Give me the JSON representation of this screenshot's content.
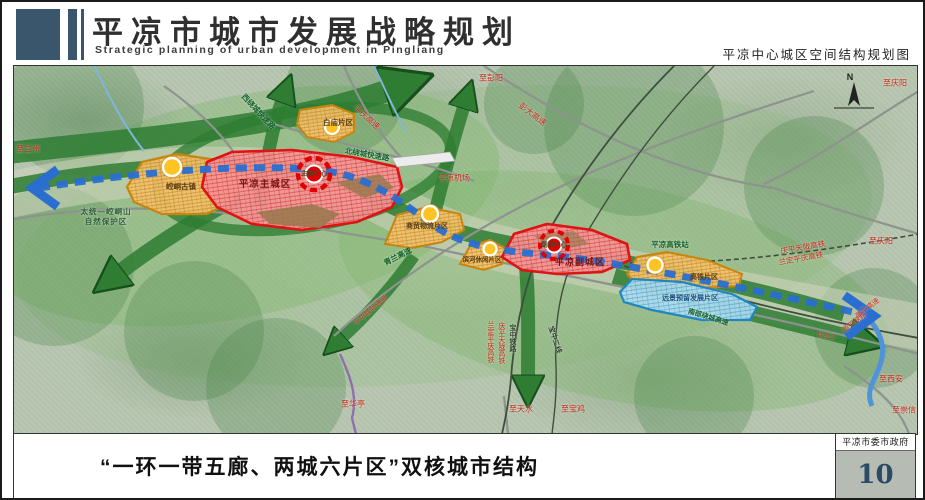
{
  "header": {
    "title_cn": "平凉市城市发展战略规划",
    "title_en": "Strategic planning of urban development in Pingliang",
    "map_subtitle": "平凉中心城区空间结构规划图"
  },
  "footer": {
    "caption": "“一环一带五廊、两城六片区”双核城市结构",
    "gov_label": "平凉市委市政府",
    "page_number": "10"
  },
  "map": {
    "compass_label": "N",
    "colors": {
      "corridor_green": "#2e7d32",
      "axis_blue": "#2a6fd0",
      "city_red": "#e01212",
      "zone_orange": "#e8a12c",
      "reserve_blue": "#1f86c0",
      "terrain": "#b7c6b0"
    },
    "labels": [
      {
        "id": "to-lanzhou",
        "text": "至兰州",
        "kind": "red"
      },
      {
        "id": "west-ring-road",
        "text": "西绕城快速路",
        "kind": "green"
      },
      {
        "id": "north-ring-road",
        "text": "北绕城快速路",
        "kind": "green"
      },
      {
        "id": "pingqing-expressway",
        "text": "平庆高速",
        "kind": "red"
      },
      {
        "id": "to-pengyang",
        "text": "至彭阳",
        "kind": "red"
      },
      {
        "id": "pengda-expressway",
        "text": "彭大高速",
        "kind": "red"
      },
      {
        "id": "to-qingyang-top",
        "text": "至庆阳",
        "kind": "red"
      },
      {
        "id": "pingliang-airport",
        "text": "平凉机场",
        "kind": "red"
      },
      {
        "id": "qinglan-expressway",
        "text": "青兰高速",
        "kind": "green"
      },
      {
        "id": "nature-reserve-line1",
        "text": "太统—崆峒山",
        "kind": "nature"
      },
      {
        "id": "nature-reserve-line2",
        "text": "自然保护区",
        "kind": "nature"
      },
      {
        "id": "main-city",
        "text": "平凉主城区",
        "kind": "city"
      },
      {
        "id": "main-center",
        "text": "主城中心",
        "kind": "center"
      },
      {
        "id": "kongtong-town",
        "text": "崆峒古镇",
        "kind": "zone"
      },
      {
        "id": "baimiao-district",
        "text": "白庙片区",
        "kind": "zone"
      },
      {
        "id": "logistics-district",
        "text": "商贸物流片区",
        "kind": "zone"
      },
      {
        "id": "riverside-district",
        "text": "滨河休闲片区",
        "kind": "zone"
      },
      {
        "id": "sub-city",
        "text": "平凉副城区",
        "kind": "city"
      },
      {
        "id": "sub-center",
        "text": "副城中心",
        "kind": "center"
      },
      {
        "id": "hsr-station",
        "text": "平凉高铁站",
        "kind": "green"
      },
      {
        "id": "hsr-district",
        "text": "高铁片区",
        "kind": "zone"
      },
      {
        "id": "reserve-district",
        "text": "远景预留发展片区",
        "kind": "reserve"
      },
      {
        "id": "south-ring-expressway",
        "text": "南部绕城高速",
        "kind": "green"
      },
      {
        "id": "qingpingtianlong-hsr",
        "text": "庆平天陇高铁",
        "kind": "red"
      },
      {
        "id": "landingpingqing-hsr",
        "text": "兰定平庆高铁",
        "kind": "red"
      },
      {
        "id": "to-qingyang-east",
        "text": "至庆阳",
        "kind": "red"
      },
      {
        "id": "g312",
        "text": "G312",
        "kind": "red"
      },
      {
        "id": "xiping-expressway",
        "text": "西平高速",
        "kind": "red"
      },
      {
        "id": "xiping-railway",
        "text": "西平铁路",
        "kind": "red"
      },
      {
        "id": "to-xian",
        "text": "至西安",
        "kind": "red"
      },
      {
        "id": "to-chongxin",
        "text": "至崇信",
        "kind": "red"
      },
      {
        "id": "to-tianshui",
        "text": "至天水",
        "kind": "red"
      },
      {
        "id": "to-baoji",
        "text": "至宝鸡",
        "kind": "red"
      },
      {
        "id": "to-huating",
        "text": "至华亭",
        "kind": "red"
      },
      {
        "id": "pinghua-corridor",
        "text": "平华城际通道",
        "kind": "red"
      },
      {
        "id": "landingpingqing-hsr-v",
        "text": "兰定平庆高铁",
        "kind": "red"
      },
      {
        "id": "qingpingtianlong-hsr-v",
        "text": "庆平天陇高铁",
        "kind": "red"
      },
      {
        "id": "baozhong-railway",
        "text": "宝中铁路",
        "kind": "dark"
      },
      {
        "id": "baozhong-line2",
        "text": "宝中二线",
        "kind": "dark"
      }
    ]
  }
}
